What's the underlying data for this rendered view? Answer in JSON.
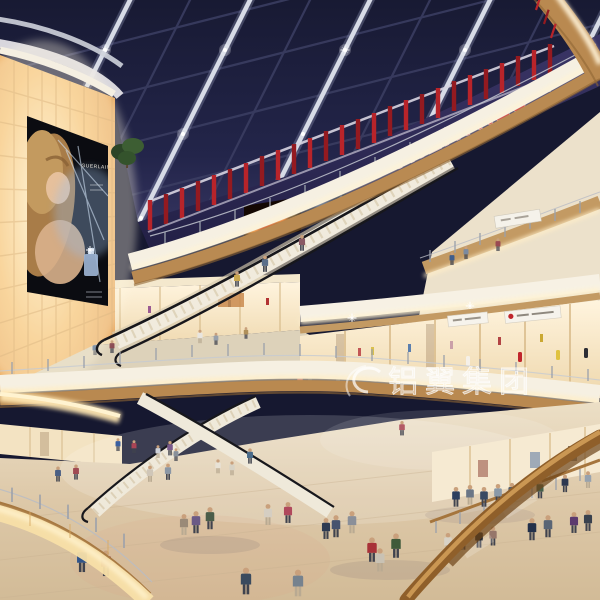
{
  "scene": {
    "type": "shopping-mall-atrium-rendering",
    "description": "Multi-level shopping mall atrium interior with skylight ceiling, cinema level, billboard wall, escalators, storefronts and shoppers",
    "signs": {
      "theatres": "THEATRES",
      "watermark": "铝翼集团",
      "billboard_brand": "GUERLAIN"
    },
    "palette": {
      "skylight_navy": "#1f2240",
      "beam_white": "#d7dbe6",
      "theatre_red": "#bf2228",
      "wood": "#b98950",
      "fascia_cream": "#f6f0e3",
      "cove_glow": "#ffeec2",
      "amber_wall": "#f2bd74",
      "floor_beige": "#decab0",
      "screen_fire_orange": "#ff7b1f"
    }
  }
}
